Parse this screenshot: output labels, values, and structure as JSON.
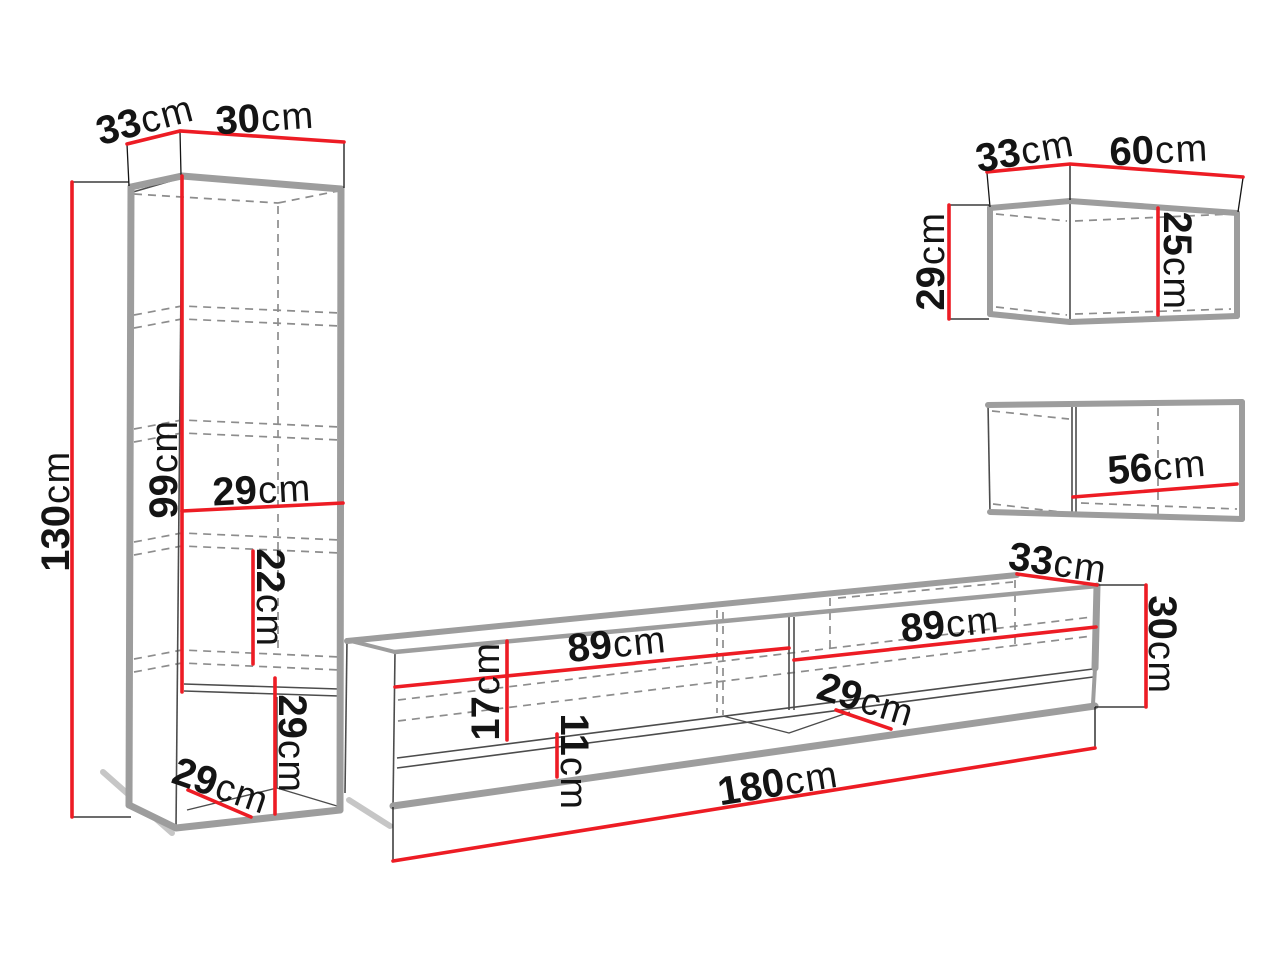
{
  "meta": {
    "unit": "cm",
    "colors": {
      "accent": "#ed1c24",
      "outline": "#9d9d9d",
      "line": "#4c4c4c",
      "dash": "#8d8d8d",
      "ink": "#141414",
      "shadow": "#c6c6c6"
    }
  },
  "pieces": [
    {
      "name": "tall-cabinet",
      "measurements_cm": [
        "33",
        "30",
        "130",
        "99",
        "29",
        "22",
        "29",
        "29"
      ]
    },
    {
      "name": "tv-stand",
      "measurements_cm": [
        "89",
        "89",
        "17",
        "11",
        "29",
        "33",
        "30",
        "180"
      ]
    },
    {
      "name": "wall-cabinet-upper",
      "measurements_cm": [
        "33",
        "60",
        "29",
        "25"
      ]
    },
    {
      "name": "wall-cabinet-lower",
      "measurements_cm": [
        "56"
      ]
    }
  ],
  "labels": {
    "tall_d33": {
      "value": "33",
      "unit": "cm"
    },
    "tall_d30": {
      "value": "30",
      "unit": "cm"
    },
    "tall_d130": {
      "value": "130",
      "unit": "cm"
    },
    "tall_d99": {
      "value": "99",
      "unit": "cm"
    },
    "tall_d29_shelf": {
      "value": "29",
      "unit": "cm"
    },
    "tall_d22": {
      "value": "22",
      "unit": "cm"
    },
    "tall_d29_height": {
      "value": "29",
      "unit": "cm"
    },
    "tall_d29_depth": {
      "value": "29",
      "unit": "cm"
    },
    "tv_d89_left": {
      "value": "89",
      "unit": "cm"
    },
    "tv_d89_right": {
      "value": "89",
      "unit": "cm"
    },
    "tv_d17": {
      "value": "17",
      "unit": "cm"
    },
    "tv_d11": {
      "value": "11",
      "unit": "cm"
    },
    "tv_d29_depth": {
      "value": "29",
      "unit": "cm"
    },
    "tv_d33_depth": {
      "value": "33",
      "unit": "cm"
    },
    "tv_d30_height": {
      "value": "30",
      "unit": "cm"
    },
    "tv_d180": {
      "value": "180",
      "unit": "cm"
    },
    "wt_d33": {
      "value": "33",
      "unit": "cm"
    },
    "wt_d60": {
      "value": "60",
      "unit": "cm"
    },
    "wt_d29": {
      "value": "29",
      "unit": "cm"
    },
    "wt_d25": {
      "value": "25",
      "unit": "cm"
    },
    "wb_d56": {
      "value": "56",
      "unit": "cm"
    }
  }
}
